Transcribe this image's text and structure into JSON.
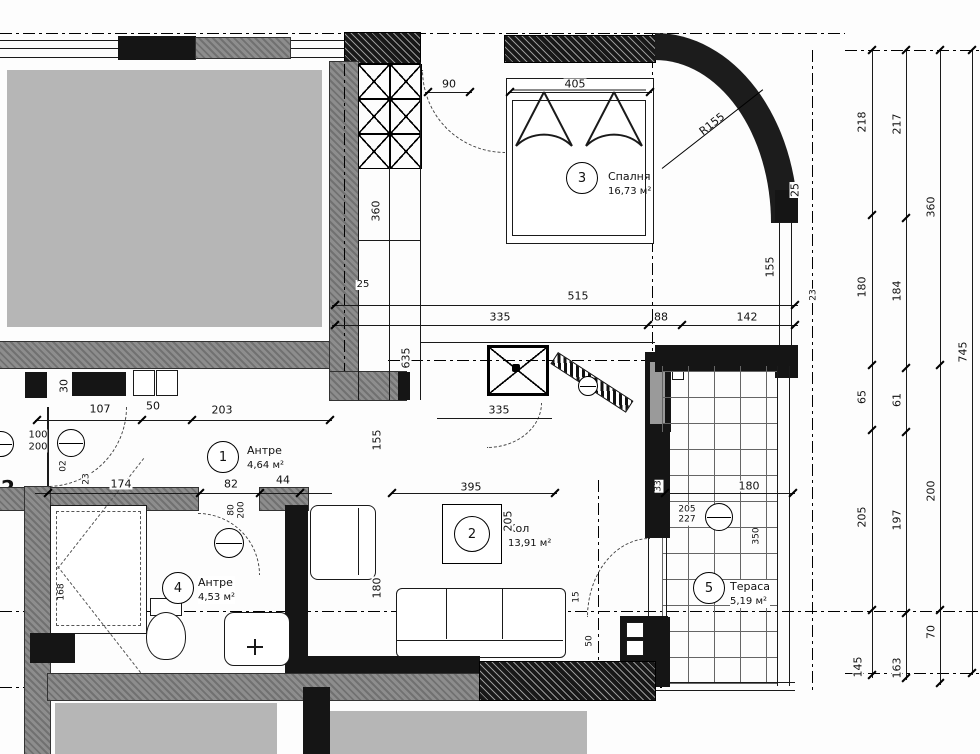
{
  "drawing": {
    "axis_label": "2",
    "colors": {
      "wall_grey": "#8d8d8d",
      "redaction_grey": "#b6b6b6",
      "line_black": "#1a1a1a"
    },
    "rooms": [
      {
        "num": "1",
        "name": "Антре",
        "area": "4,64 м²"
      },
      {
        "num": "2",
        "name": "Хол",
        "area": "13,91 м²"
      },
      {
        "num": "3",
        "name": "Спалня",
        "area": "16,73 м²"
      },
      {
        "num": "4",
        "name": "Антре",
        "area": "4,53 м²"
      },
      {
        "num": "5",
        "name": "Тераса",
        "area": "5,19 м²"
      }
    ],
    "door_tags": {
      "entrance": {
        "w": "100",
        "h": "200"
      },
      "bath": {
        "w": "80",
        "h": "200"
      },
      "terrace": {
        "w": "205",
        "h": "227"
      }
    },
    "dims": {
      "top_90": "90",
      "top_405": "405",
      "r155": "R155",
      "r_25": "25",
      "r_155": "155",
      "r_23": "23",
      "c1_218": "218",
      "c2_217": "217",
      "c3_360": "360",
      "c1_180": "180",
      "c2_184": "184",
      "c4_745": "745",
      "mid_515": "515",
      "mid_335": "335",
      "mid_88": "88",
      "mid_142": "142",
      "l_30": "30",
      "l_107": "107",
      "l_50": "50",
      "l_203": "203",
      "l_02": "02",
      "l_23": "23",
      "l_174": "174",
      "l_82": "82",
      "l_44": "44",
      "v_360": "360",
      "v_635": "635",
      "v_25": "25",
      "v_155": "155",
      "k_335": "335",
      "r2_395": "395",
      "r2_205": "205",
      "r2_33": "33",
      "r2_15": "15",
      "r2_50": "50",
      "r2_180": "180",
      "t_180": "180",
      "t_350": "350",
      "b_168": "168",
      "rc1_65": "65",
      "rc2_61": "61",
      "rc3_200": "200",
      "rc1_205": "205",
      "rc2_197": "197",
      "rc3_70": "70",
      "rc1_145": "145",
      "rc2_163": "163"
    }
  }
}
